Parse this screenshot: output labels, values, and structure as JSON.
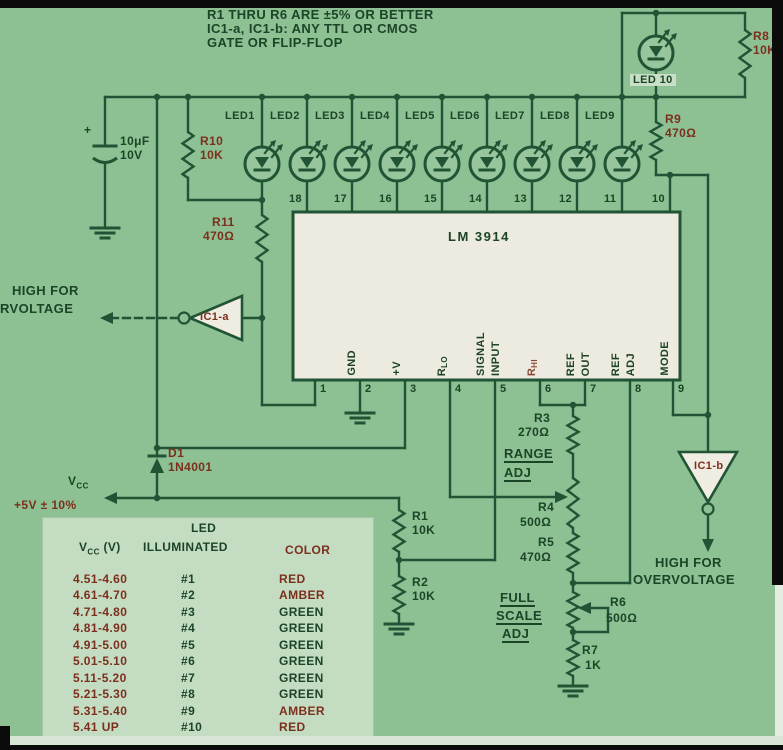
{
  "colors": {
    "background": "#8dc093",
    "line": "#215434",
    "text_dark": "#1c4426",
    "text_red": "#7c2f1d",
    "ic_body": "#edeadf",
    "table_bg": "#c4dcc2",
    "gate_body": "#efece2",
    "black": "#0b0b0b",
    "led_fill": "#97c59c",
    "pin6_faded": "#8a4a35"
  },
  "notes": {
    "line1": "R1 THRU R6 ARE ±5% OR BETTER",
    "line2": "IC1-a, IC1-b: ANY TTL OR CMOS",
    "line3": "GATE OR FLIP-FLOP"
  },
  "components": {
    "c1": {
      "plus": "+",
      "value": "10μF",
      "voltage": "10V"
    },
    "r1": {
      "name": "R1",
      "value": "10K"
    },
    "r2": {
      "name": "R2",
      "value": "10K"
    },
    "r3": {
      "name": "R3",
      "value": "270Ω"
    },
    "r4": {
      "name": "R4",
      "value": "500Ω"
    },
    "r5": {
      "name": "R5",
      "value": "470Ω"
    },
    "r6": {
      "name": "R6",
      "value": "500Ω"
    },
    "r7": {
      "name": "R7",
      "value": "1K"
    },
    "r8": {
      "name": "R8",
      "value": "10K"
    },
    "r9": {
      "name": "R9",
      "value": "470Ω"
    },
    "r10": {
      "name": "R10",
      "value": "10K"
    },
    "r11": {
      "name": "R11",
      "value": "470Ω"
    },
    "d1": {
      "name": "D1",
      "value": "1N4001"
    }
  },
  "leds": {
    "row": [
      "LED1",
      "LED2",
      "LED3",
      "LED4",
      "LED5",
      "LED6",
      "LED7",
      "LED8",
      "LED9"
    ],
    "led10": "LED 10"
  },
  "ic": {
    "name": "LM 3914",
    "pins_top": [
      "18",
      "17",
      "16",
      "15",
      "14",
      "13",
      "12",
      "11",
      "10"
    ],
    "pins_bottom": [
      {
        "num": "1"
      },
      {
        "num": "2",
        "lines": [
          "GND"
        ]
      },
      {
        "num": "3",
        "lines": [
          "+V"
        ]
      },
      {
        "num": "4",
        "lines": [
          "R"
        ],
        "sub": "LO"
      },
      {
        "num": "5",
        "lines": [
          "SIGNAL",
          "INPUT"
        ]
      },
      {
        "num": "6",
        "lines": [
          "R"
        ],
        "sub": "HI",
        "faded": true
      },
      {
        "num": "7",
        "lines": [
          "REF",
          "OUT"
        ]
      },
      {
        "num": "8",
        "lines": [
          "REF",
          "ADJ"
        ]
      },
      {
        "num": "9",
        "lines": [
          "MODE"
        ]
      }
    ]
  },
  "gates": {
    "ic1a": "IC1-a",
    "ic1b": "IC1-b",
    "left_out_line1": "HIGH FOR",
    "left_out_line2": "RVOLTAGE",
    "right_out_line1": "HIGH FOR",
    "right_out_line2": "OVERVOLTAGE"
  },
  "power": {
    "vcc": "V",
    "vcc_sub": "CC",
    "vcc_tolerance": "+5V ± 10%"
  },
  "adjust": {
    "range_line1": "RANGE",
    "range_line2": "ADJ",
    "full_scale_line1": "FULL",
    "full_scale_line2": "SCALE",
    "full_scale_line3": "ADJ"
  },
  "table": {
    "header_led": "LED",
    "header_vcc": "V",
    "header_vcc_sub": "CC",
    "header_vcc_unit": "(V)",
    "header_illuminated": "ILLUMINATED",
    "header_color": "COLOR",
    "rows": [
      {
        "vcc": "4.51-4.60",
        "led": "#1",
        "color": "RED"
      },
      {
        "vcc": "4.61-4.70",
        "led": "#2",
        "color": "AMBER"
      },
      {
        "vcc": "4.71-4.80",
        "led": "#3",
        "color": "GREEN"
      },
      {
        "vcc": "4.81-4.90",
        "led": "#4",
        "color": "GREEN"
      },
      {
        "vcc": "4.91-5.00",
        "led": "#5",
        "color": "GREEN"
      },
      {
        "vcc": "5.01-5.10",
        "led": "#6",
        "color": "GREEN"
      },
      {
        "vcc": "5.11-5.20",
        "led": "#7",
        "color": "GREEN"
      },
      {
        "vcc": "5.21-5.30",
        "led": "#8",
        "color": "GREEN"
      },
      {
        "vcc": "5.31-5.40",
        "led": "#9",
        "color": "AMBER"
      },
      {
        "vcc": "5.41 UP",
        "led": "#10",
        "color": "RED"
      }
    ]
  }
}
